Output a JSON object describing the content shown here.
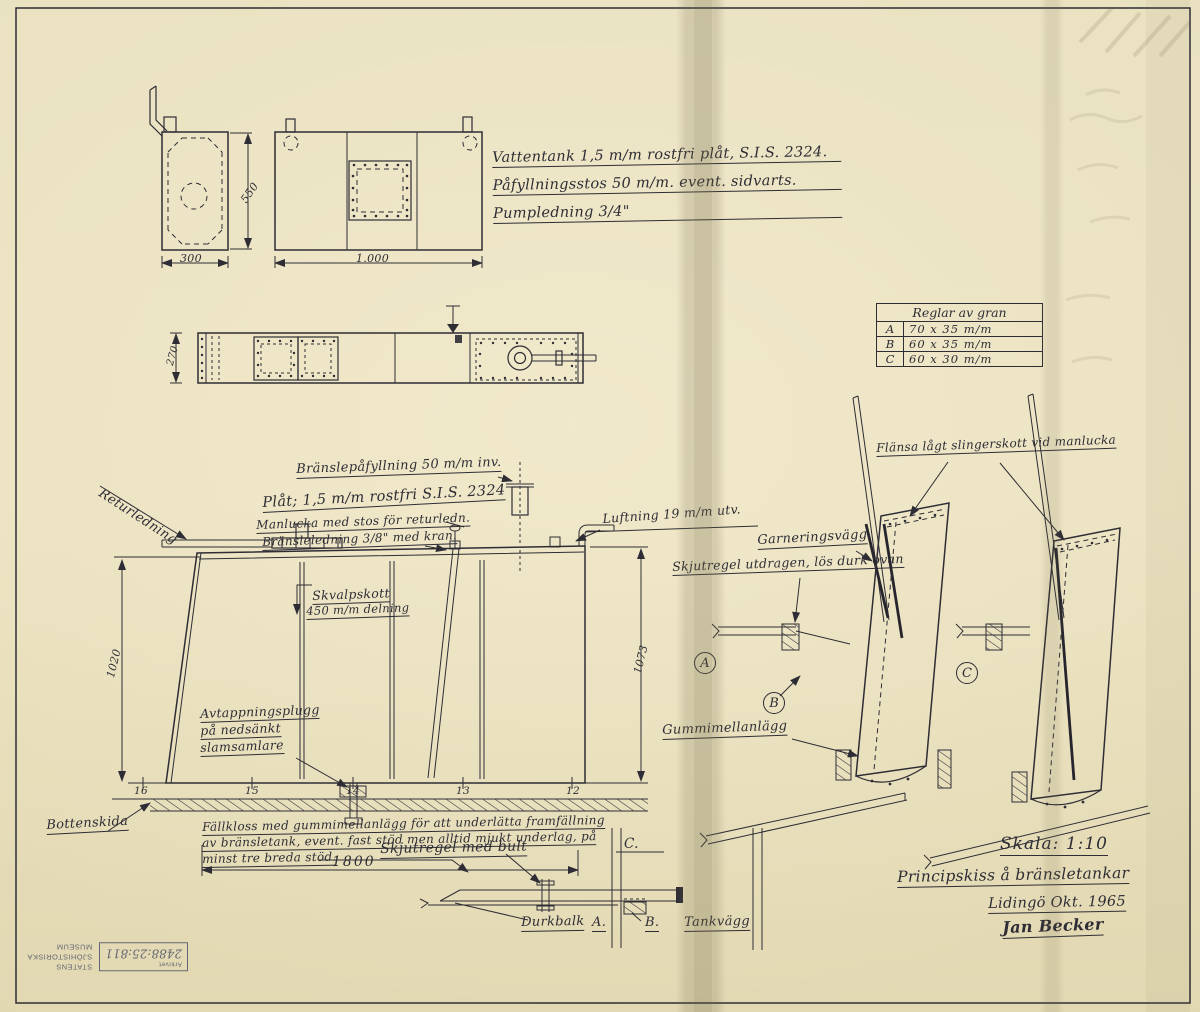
{
  "notes": {
    "vattentank": "Vattentank 1,5 m/m rostfri plåt, S.I.S. 2324.",
    "pafyllningsstos": "Påfyllningsstos 50 m/m. event. sidvarts.",
    "pumpledning": "Pumpledning 3/4\""
  },
  "table": {
    "title": "Reglar av gran",
    "rows": [
      {
        "ref": "A",
        "size": "70 x 35 m/m"
      },
      {
        "ref": "B",
        "size": "60 x 35 m/m"
      },
      {
        "ref": "C",
        "size": "60 x 30 m/m"
      }
    ]
  },
  "labels": {
    "returledning": "Returledning",
    "bransle_pafyllning": "Bränslepåfyllning 50 m/m inv.",
    "plat": "Plåt; 1,5 m/m rostfri S.I.S. 2324",
    "manlucka": "Manlucka med stos för returledn.",
    "bransleledning": "Bränsleledning 3/8\" med kran.",
    "luftning": "Luftning 19 m/m utv.",
    "skvalpskott_1": "Skvalpskott",
    "skvalpskott_2": "450 m/m delning",
    "avtappning_1": "Avtappningsplugg",
    "avtappning_2": "på nedsänkt",
    "avtappning_3": "slamsamlare",
    "bottenskida": "Bottenskida",
    "fallkloss_1": "Fällkloss med gummimellanlägg för att underlätta framfällning",
    "fallkloss_2": "av bränsletank, event. fast stöd men alltid mjukt underlag, på",
    "fallkloss_3": "minst tre breda stöd.",
    "skjutregel_med_bult": "Skjutregel med bult",
    "flansa": "Flänsa lågt slingerskott vid manlucka",
    "garneringsvagg": "Garneringsvägg",
    "skjutregel_utdragen": "Skjutregel utdragen, lös durk ovan",
    "gummimellanlagg": "Gummimellanlägg",
    "durkbalk": "Durkbalk",
    "tankvagg": "Tankvägg"
  },
  "dimensions": {
    "end_width": "300",
    "front_height": "550",
    "front_length": "1.000",
    "plan_depth": "270",
    "left_height": "1020",
    "right_height": "1073",
    "base_length": "1800"
  },
  "stations": [
    "16",
    "15",
    "14",
    "13",
    "12"
  ],
  "section_markers": {
    "a": "A",
    "b": "B",
    "c": "C"
  },
  "detail_refs": {
    "c": "C.",
    "a": "A.",
    "b": "B."
  },
  "title_block": {
    "scale": "Skala: 1:10",
    "title": "Principskiss å bränsletankar",
    "place_date": "Lidingö Okt. 1965",
    "signature": "Jan Becker"
  },
  "stamp": {
    "org_line1": "STATENS",
    "org_line2": "SJÖHISTORISKA",
    "org_line3": "MUSEUM",
    "dept": "Arkivet",
    "ref": "2488:25:811"
  }
}
